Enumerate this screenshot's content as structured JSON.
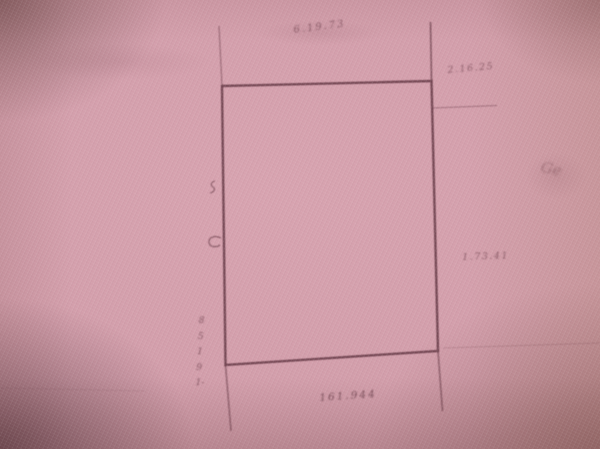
{
  "colors": {
    "paper": "#d09ba8",
    "ink": "#5e323e",
    "label_ink": "#5c2e3c"
  },
  "plat": {
    "labels": {
      "top": "6.19.73",
      "top_right": "2.16.25",
      "right": "1.73.41",
      "bottom": "161.944",
      "left_vertical": "85191-",
      "scribble": "Ge"
    }
  }
}
